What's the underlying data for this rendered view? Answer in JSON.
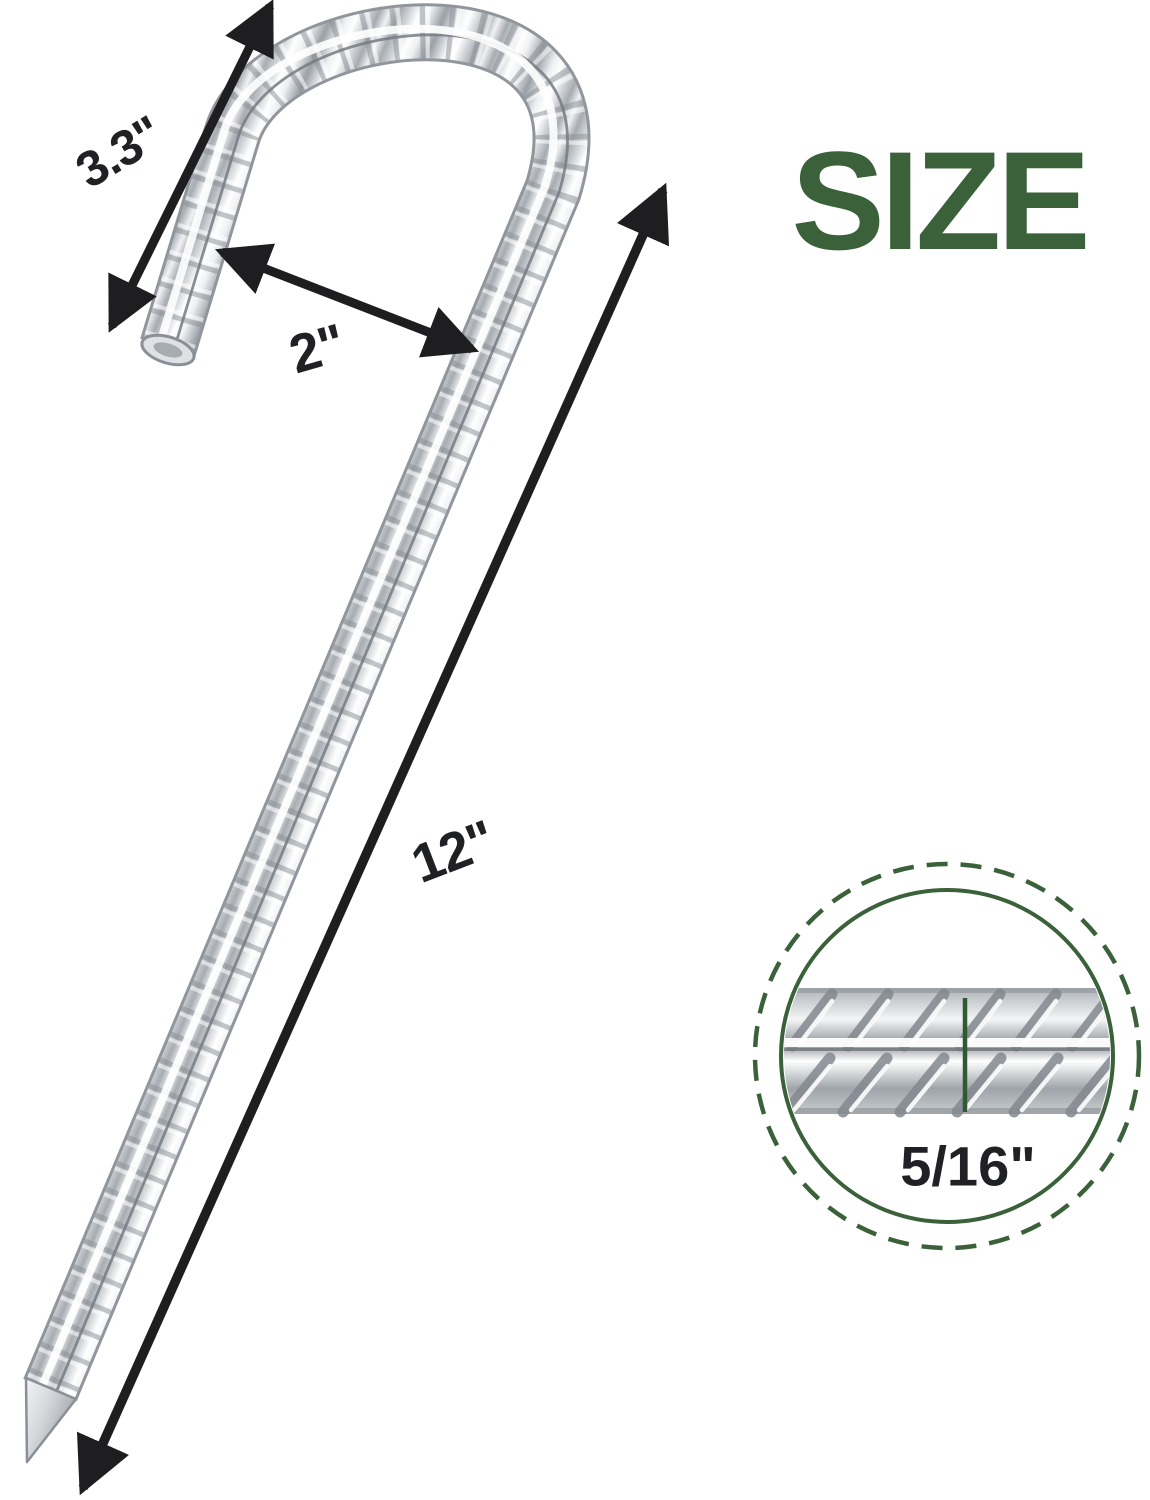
{
  "title": "SIZE",
  "dimensions": {
    "hook_length": "3.3\"",
    "hook_opening": "2\"",
    "total_length": "12\"",
    "rod_diameter": "5/16\""
  },
  "illustration": {
    "subject": "rebar J-hook ground stake",
    "detail_view": "rod diameter close-up in dashed circle"
  },
  "colors": {
    "background": "#ffffff",
    "title_green": "#3a6139",
    "circle_green": "#3a6139",
    "diameter_line_green": "#2f5a34",
    "arrow_black": "#1e1e20",
    "label_black": "#202124"
  }
}
